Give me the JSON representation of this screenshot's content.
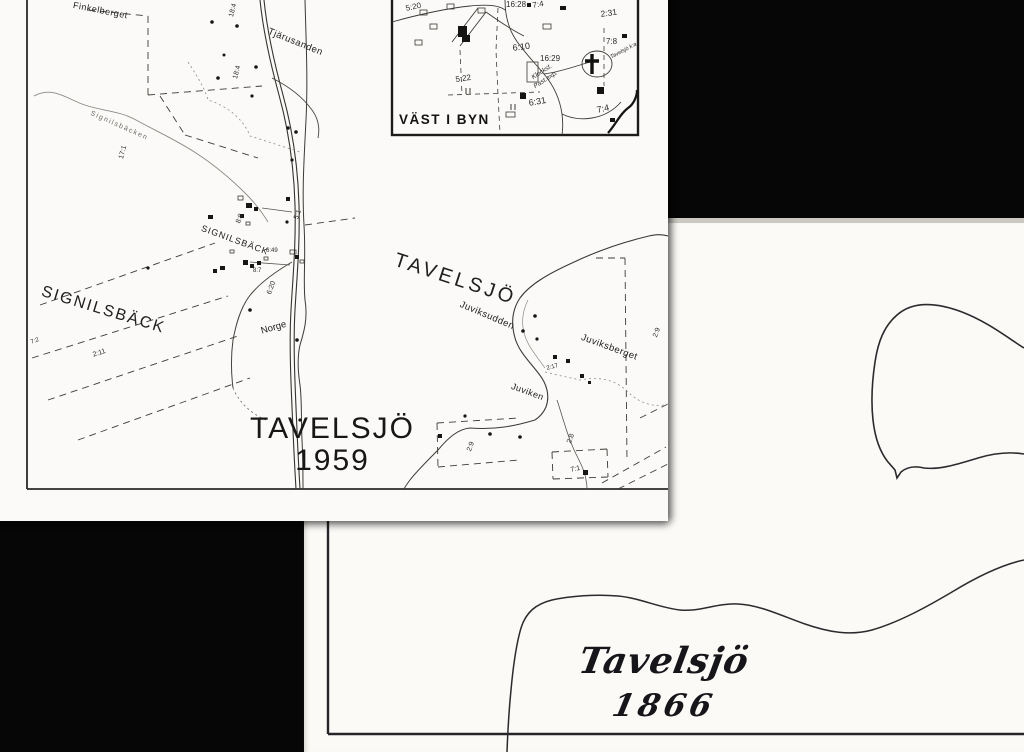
{
  "document": {
    "description_labels": {
      "map_1959_title_line1": "TAVELSJÖ",
      "map_1959_title_line2": "1959",
      "map_1866_title_line1": "Tavelsjö",
      "map_1866_title_line2": "1866"
    }
  },
  "map_1959": {
    "title_line1": "TAVELSJÖ",
    "title_line2": "1959",
    "lake_label": "TAVELSJÖ",
    "place_labels": [
      {
        "text": "Finkelberget"
      },
      {
        "text": "Tjärusanden"
      },
      {
        "text": "Signilsbäcken"
      },
      {
        "text": "SIGNILSBÄCK"
      },
      {
        "text": "SIGNILSBÄCK"
      },
      {
        "text": "Norge"
      },
      {
        "text": "Juviksudden"
      },
      {
        "text": "Juviksberget"
      },
      {
        "text": "Juviken"
      }
    ],
    "parcel_numbers": [
      "18:4",
      "18:4",
      "17:1",
      "8:8",
      "5:1",
      "6:49",
      "8:7",
      "6:20",
      "7:2",
      "2:11",
      "2:9",
      "2:17",
      "2:9",
      "2:8",
      "7:1"
    ],
    "inset": {
      "caption": "VÄST I BYN",
      "numbers": [
        "5:20",
        "16:28",
        "7:4",
        "2:31",
        "7:8",
        "6:10",
        "16:29",
        "5:22",
        "6:31",
        "7:4"
      ],
      "notes": [
        "Klockst.",
        "Past.exp.",
        "Tavelsjö k:a"
      ]
    }
  },
  "map_1866": {
    "title_line1": "Tavelsjö",
    "title_line2": "1866"
  },
  "colors": {
    "scanner_background": "#060606",
    "paper": "#fbfaf8",
    "map_ink": "#222220",
    "light_ink": "#6b6b66"
  }
}
